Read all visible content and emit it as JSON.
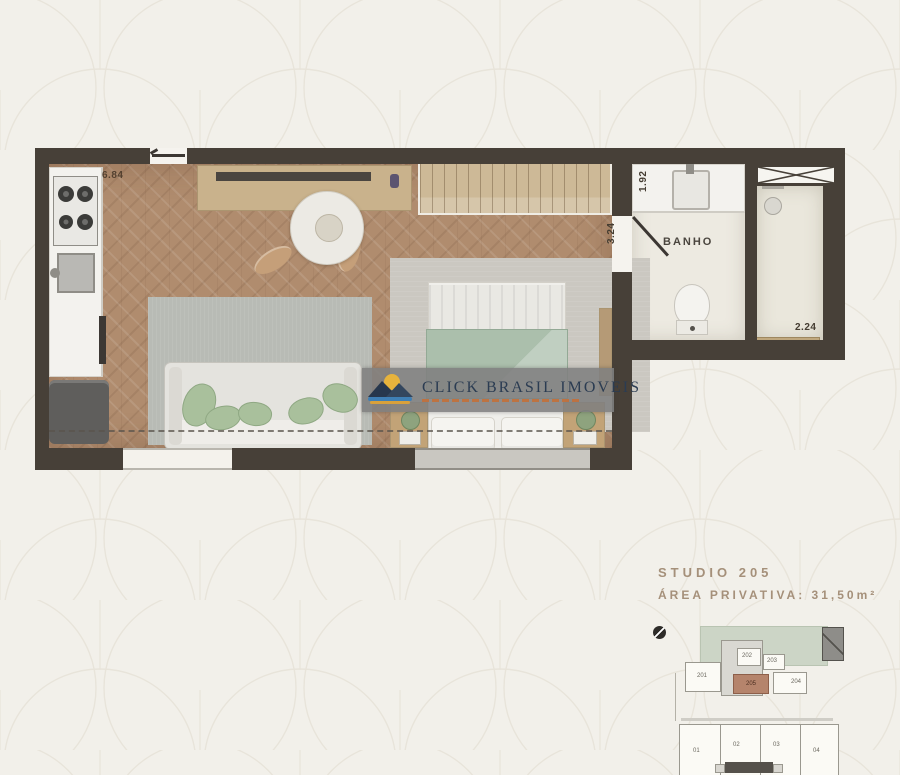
{
  "background": {
    "color": "#f2f0ea",
    "pattern": "scallop-arc wallpaper",
    "pattern_line_color": "#e8e4da"
  },
  "watermark": {
    "brand": "CLICK BRASIL IMOVEIS",
    "logo": "sun-beach-logo"
  },
  "floor_plan": {
    "labels": {
      "bathroom": "BANHO"
    },
    "dimensions": {
      "entry_width": "6.84",
      "bath_width": "1.92",
      "room_depth": "3.24",
      "shower_width": "2.24"
    },
    "colors": {
      "wall": "#474038",
      "wood_floor": "#b08c6e",
      "bath_floor": "#edeae1",
      "living_rug": "#b8bbb5",
      "bed_rug": "#cbc8c1",
      "blanket": "#abbfac",
      "pillow_green": "#a9c09c",
      "furniture_wood": "#c9b28c",
      "keyplan_highlight": "#b5846c"
    }
  },
  "unit_info": {
    "title": "STUDIO 205",
    "area": "ÁREA PRIVATIVA: 31,50m²"
  },
  "keyplan": {
    "upper_units": [
      "201",
      "202",
      "203",
      "204"
    ],
    "highlighted_unit": "205",
    "lower_units": [
      "01",
      "02",
      "03",
      "04"
    ]
  }
}
